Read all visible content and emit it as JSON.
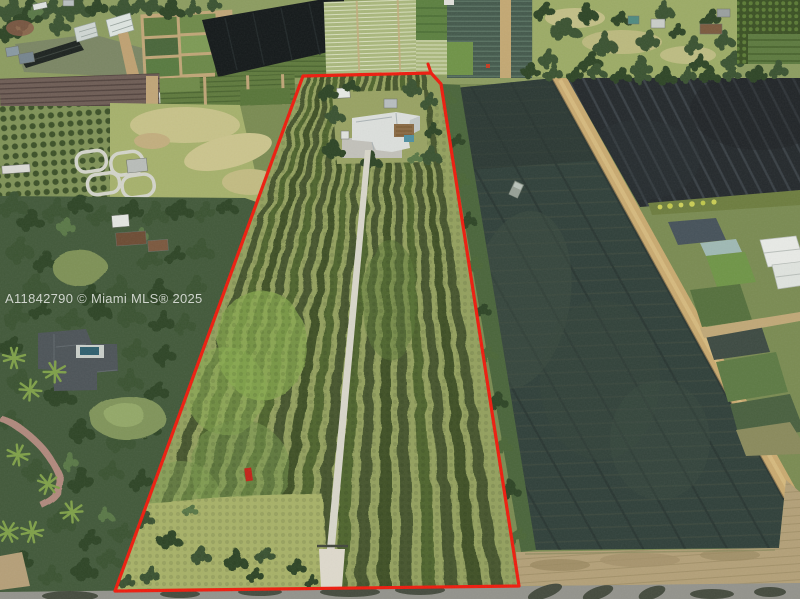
{
  "watermark": {
    "text": "A11842790 © Miami MLS® 2025"
  },
  "scene": {
    "type": "aerial-drone-photo",
    "subject": "nursery farmland with subject parcel outlined in red",
    "boundary": {
      "color": "#ee1c0e",
      "points": "303,76 431,73 441,84 519,586 115,591",
      "spur_points": "431,73 428,64"
    },
    "colors": {
      "boundary_red": "#ee1c0e",
      "shade_cloth": "#2f3d34",
      "shade_cloth_dark": "#24292c",
      "gravel_driveway": "#d8d6ca",
      "dirt_road": "#c9aa70",
      "asphalt_road": "#93938c",
      "hedge_green": "#46572e",
      "grass_green": "#93a05e"
    }
  }
}
